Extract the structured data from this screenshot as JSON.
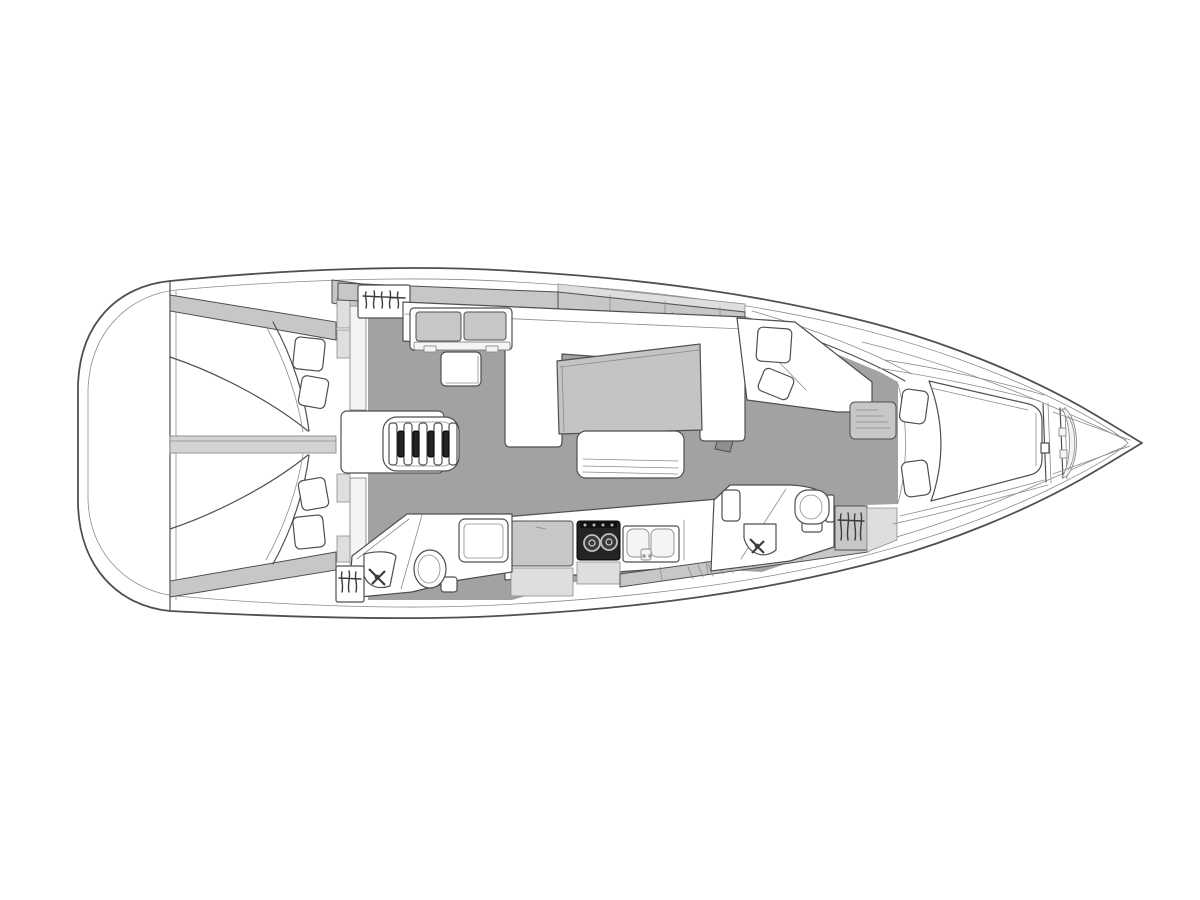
{
  "diagram": {
    "kind": "sailing-yacht-interior-floor-plan",
    "orientation": "bow-right",
    "areas": [
      "swim-platform",
      "aft-cabin-port",
      "aft-cabin-starboard",
      "cabin-divider",
      "wardrobe-top",
      "wardrobe-aft-lower",
      "companionway-steps",
      "salon-settee",
      "corner-seat",
      "side-table",
      "salon-table",
      "salon-bench",
      "chaise-seat",
      "mast-step",
      "aft-head",
      "shower-pan",
      "galley",
      "fridge-counter",
      "stove",
      "double-sink",
      "fwd-head",
      "wardrobe-fwd",
      "dresser-steps",
      "fwd-cabin-island-berth",
      "bed-pillows",
      "bow-anchor-locker",
      "windlass"
    ],
    "fixtures": [
      "toilet",
      "wash-basin",
      "faucet",
      "clothes-hangers",
      "stove-burners",
      "sink-basins"
    ]
  },
  "colors": {
    "background": "#ffffff",
    "line": "#4f4f4f",
    "line-light": "#8c8c8c",
    "floor": "#a2a2a2",
    "panel": "#c7c7c7",
    "panel-light": "#dedede",
    "divider": "#d3d3d3",
    "table": "#c4c4c4",
    "white": "#ffffff",
    "near-white": "#f4f4f4",
    "dark": "#242424",
    "stove-inner": "#3a3a3a",
    "metal": "#bfbfbf"
  }
}
